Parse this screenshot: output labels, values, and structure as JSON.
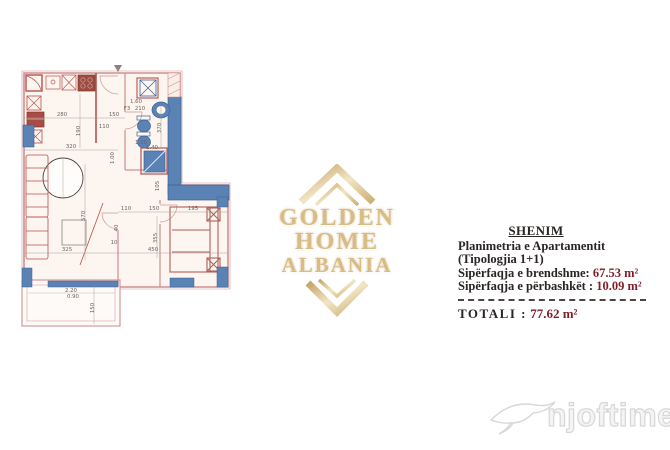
{
  "logo": {
    "line1": "GOLDEN HOME",
    "line2": "ALBANIA",
    "gold_color": "#c9a96b"
  },
  "note": {
    "heading": "SHENIM",
    "line1": "Planimetria e Apartamentit",
    "line2": "(Tipologjia 1+1)",
    "line3_label": "Sipërfaqja e brendshme:",
    "line3_value": "67.53 m²",
    "line4_label": "Sipërfaqja e përbashkët :",
    "line4_value": "10.09 m²",
    "total_label": "TOTALI :",
    "total_value": "77.62 m²",
    "value_color": "#7d1f2a"
  },
  "watermark": {
    "text": "njoftime.al"
  },
  "floor_plan": {
    "wall_color": "#cf9090",
    "accent_red": "#b8514e",
    "fixture_blue": "#5b82b4",
    "dim_text_color": "#6d625e",
    "dimensions": [
      {
        "t": "280",
        "x": 48,
        "y": 64
      },
      {
        "t": "150",
        "x": 100,
        "y": 64
      },
      {
        "t": "110",
        "x": 90,
        "y": 76
      },
      {
        "t": "190",
        "x": 66,
        "y": 79,
        "r": 1
      },
      {
        "t": "320",
        "x": 57,
        "y": 96
      },
      {
        "t": "1.60",
        "x": 122,
        "y": 51
      },
      {
        "t": "210",
        "x": 126,
        "y": 58
      },
      {
        "t": "F3",
        "x": 113,
        "y": 58
      },
      {
        "t": "370",
        "x": 147,
        "y": 76,
        "r": 1
      },
      {
        "t": "1.10",
        "x": 127,
        "y": 92
      },
      {
        "t": "1.40",
        "x": 138,
        "y": 97
      },
      {
        "t": "1.00",
        "x": 100,
        "y": 106,
        "r": 1
      },
      {
        "t": "105",
        "x": 145,
        "y": 134,
        "r": 1
      },
      {
        "t": "570",
        "x": 71,
        "y": 164,
        "r": 1
      },
      {
        "t": "110",
        "x": 112,
        "y": 158
      },
      {
        "t": "150",
        "x": 140,
        "y": 158
      },
      {
        "t": "195",
        "x": 179,
        "y": 158
      },
      {
        "t": "40",
        "x": 104,
        "y": 176,
        "r": 1
      },
      {
        "t": "10",
        "x": 100,
        "y": 192
      },
      {
        "t": "355",
        "x": 143,
        "y": 186,
        "r": 1
      },
      {
        "t": "450",
        "x": 139,
        "y": 199
      },
      {
        "t": "325",
        "x": 53,
        "y": 199
      },
      {
        "t": "2.20",
        "x": 57,
        "y": 240
      },
      {
        "t": "0.90",
        "x": 59,
        "y": 246
      },
      {
        "t": "150",
        "x": 80,
        "y": 256,
        "r": 1
      }
    ]
  }
}
